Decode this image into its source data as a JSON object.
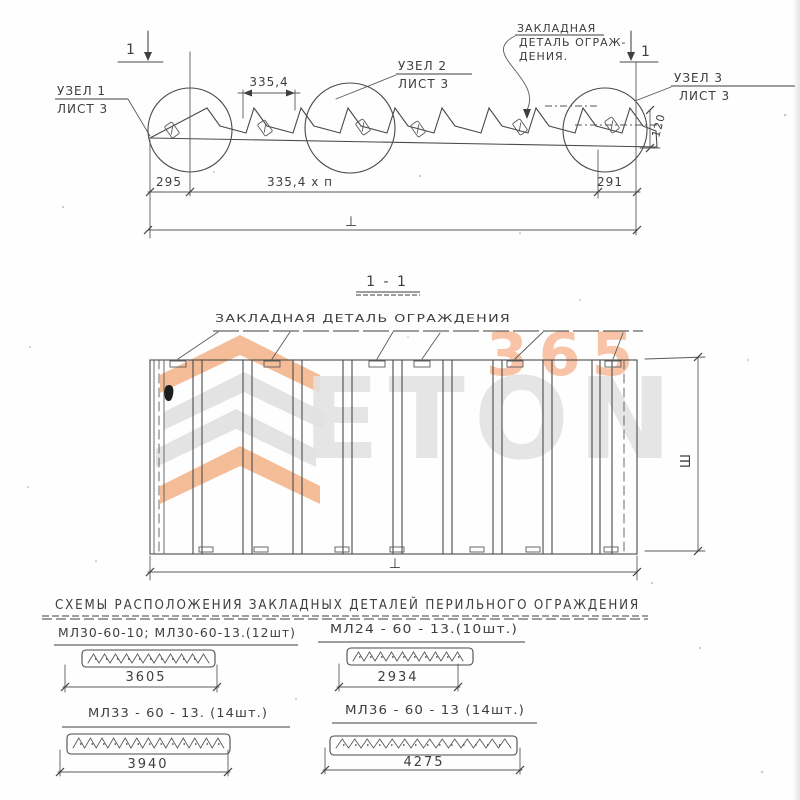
{
  "colors": {
    "ink": "#3f3f3f",
    "watermark_orange": "#f2a470",
    "watermark_gray": "#d9d9d9",
    "watermark_digits": "#f6b28c"
  },
  "elevation": {
    "section_marker": "1",
    "node1_line1": "УЗЕЛ 1",
    "node1_line2": "ЛИСТ 3",
    "node2_line1": "УЗЕЛ 2",
    "node2_line2": "ЛИСТ 3",
    "node3_line1": "УЗЕЛ 3",
    "node3_line2": "ЛИСТ 3",
    "callout_line1": "ЗАКЛАДНАЯ",
    "callout_line2": "ДЕТАЛЬ ОГРАЖ-",
    "callout_line3": "ДЕНИЯ.",
    "dim_step": "335,4",
    "dim_edge_height": "120",
    "dim_left": "295",
    "dim_middle": "335,4 x п",
    "dim_right": "291",
    "dim_total_symbol": "⊥"
  },
  "section_view": {
    "title": "1 - 1",
    "label": "ЗАКЛАДНАЯ ДЕТАЛЬ ОГРАЖДЕНИЯ",
    "dim_width_symbol": "Ш",
    "dim_length_symbol": "⊥"
  },
  "schemes": {
    "heading": "СХЕМЫ РАСПОЛОЖЕНИЯ ЗАКЛАДНЫХ ДЕТАЛЕЙ ПЕРИЛЬНОГО ОГРАЖДЕНИЯ",
    "items": [
      {
        "label": "МЛ30-60-10; МЛ30-60-13.(12шт)",
        "dim": "3605"
      },
      {
        "label": "МЛ24 - 60 - 13.(10шт.)",
        "dim": "2934"
      },
      {
        "label": "МЛ33 - 60 - 13. (14шт.)",
        "dim": "3940"
      },
      {
        "label": "МЛ36 - 60 - 13 (14шт.)",
        "dim": "4275"
      }
    ]
  },
  "watermark": {
    "digits": "365",
    "letters": "ETON"
  }
}
